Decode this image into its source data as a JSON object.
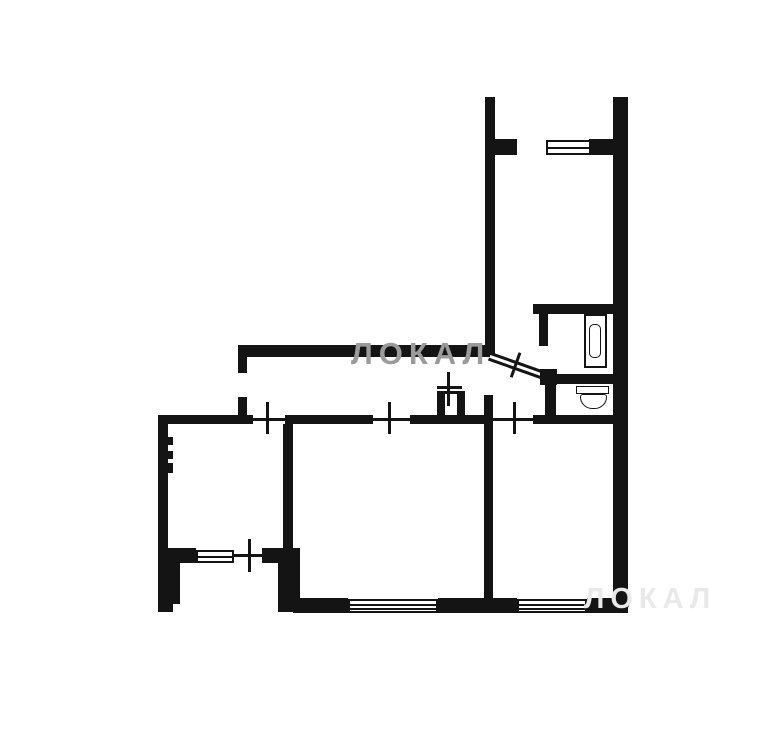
{
  "watermarks": {
    "primary": {
      "text": "ЛОКАЛ",
      "color": "#9b9b9b"
    },
    "faint": {
      "text": "ЛОКАЛ",
      "color": "#e9e9e9"
    }
  },
  "colors": {
    "wall": "#141414",
    "background": "#ffffff"
  },
  "icons": {
    "bathtub": "bathtub-icon",
    "toilet": "toilet-icon",
    "vent_shaft": "vent-shaft-icon",
    "window": "window-symbol",
    "door_marker": "door-cross-marker"
  }
}
